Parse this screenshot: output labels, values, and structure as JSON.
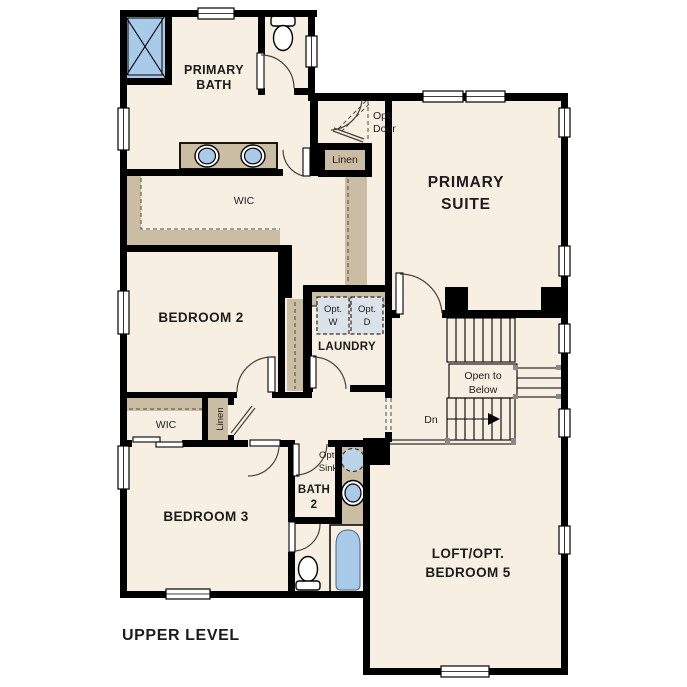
{
  "plan": {
    "title": "UPPER LEVEL",
    "rooms": {
      "primary_bath_1": "PRIMARY",
      "primary_bath_2": "BATH",
      "primary_suite_1": "PRIMARY",
      "primary_suite_2": "SUITE",
      "wic_primary": "WIC",
      "bedroom2": "BEDROOM 2",
      "laundry": "LAUNDRY",
      "bedroom3": "BEDROOM 3",
      "wic_bed3": "WIC",
      "bath2_1": "BATH",
      "bath2_2": "2",
      "loft_1": "LOFT/OPT.",
      "loft_2": "BEDROOM 5"
    },
    "labels": {
      "linen_upper": "Linen",
      "linen_lower": "Linen",
      "opt_door_1": "Opt.",
      "opt_door_2": "Door",
      "opt_w_1": "Opt.",
      "opt_w_2": "W",
      "opt_d_1": "Opt.",
      "opt_d_2": "D",
      "open_below_1": "Open to",
      "open_below_2": "Below",
      "dn": "Dn",
      "opt_sink_1": "Opt.",
      "opt_sink_2": "Sink"
    },
    "colors": {
      "floor": "#f6efe2",
      "wall": "#000000",
      "casework": "#cbbda3",
      "fixture_blue": "#a9cae8",
      "appliance": "#dce3e8",
      "background": "#ffffff"
    }
  }
}
